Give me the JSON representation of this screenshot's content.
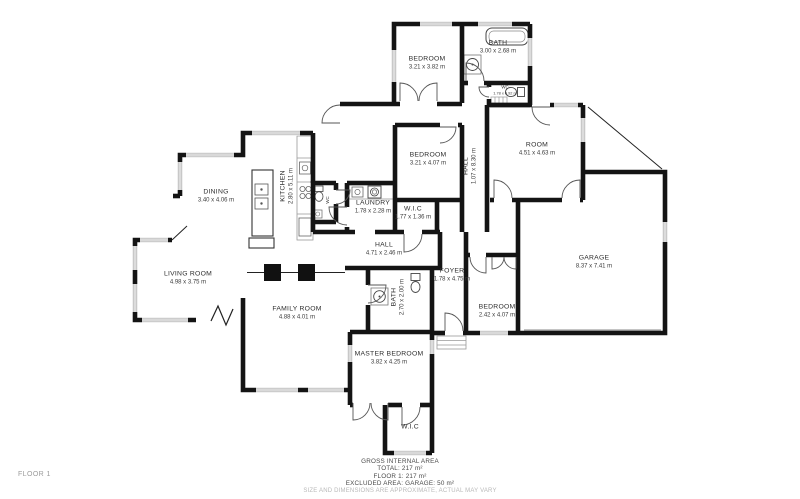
{
  "floorplan": {
    "floor_tag": "FLOOR 1",
    "rooms": [
      {
        "id": "bedroom-top",
        "name": "BEDROOM",
        "dims": "3.21 x 3.82 m"
      },
      {
        "id": "bath-top",
        "name": "BATH",
        "dims": "3.00 x 2.68 m"
      },
      {
        "id": "wc-top",
        "name": "WC",
        "dims": "1.78 x 0.92 m"
      },
      {
        "id": "bedroom-mid",
        "name": "BEDROOM",
        "dims": "3.21 x 4.07 m"
      },
      {
        "id": "hall-upper",
        "name": "HALL",
        "dims": "1.07 x 8.30 m"
      },
      {
        "id": "room",
        "name": "ROOM",
        "dims": "4.51 x 4.63 m"
      },
      {
        "id": "kitchen",
        "name": "KITCHEN",
        "dims": "2.80 x 5.11 m"
      },
      {
        "id": "dining",
        "name": "DINING",
        "dims": "3.40 x 4.06 m"
      },
      {
        "id": "wc-kitchen",
        "name": "WC",
        "dims": ""
      },
      {
        "id": "laundry",
        "name": "LAUNDRY",
        "dims": "1.78 x 2.28 m"
      },
      {
        "id": "wic-mid",
        "name": "W.I.C",
        "dims": "1.77 x 1.36 m"
      },
      {
        "id": "hall-main",
        "name": "HALL",
        "dims": "4.71 x 2.46 m"
      },
      {
        "id": "foyer",
        "name": "FOYER",
        "dims": "1.78 x 4.75 m"
      },
      {
        "id": "bath-mid",
        "name": "BATH",
        "dims": "2.70 x 2.00 m"
      },
      {
        "id": "bedroom-right",
        "name": "BEDROOM",
        "dims": "2.42 x 4.07 m"
      },
      {
        "id": "living-room",
        "name": "LIVING ROOM",
        "dims": "4.98 x 3.75 m"
      },
      {
        "id": "family-room",
        "name": "FAMILY ROOM",
        "dims": "4.88 x 4.01 m"
      },
      {
        "id": "master-bedroom",
        "name": "MASTER BEDROOM",
        "dims": "3.82 x 4.25 m"
      },
      {
        "id": "wic-bottom",
        "name": "W.I.C",
        "dims": ""
      },
      {
        "id": "garage",
        "name": "GARAGE",
        "dims": "8.37 x 7.41 m"
      }
    ],
    "footer": {
      "title": "GROSS INTERNAL AREA",
      "total": "TOTAL: 217 m²",
      "floor": "FLOOR 1: 217 m²",
      "excluded": "EXCLUDED AREA: GARAGE: 50 m²",
      "disclaimer": "SIZE AND DIMENSIONS ARE APPROXIMATE, ACTUAL MAY VARY"
    },
    "colors": {
      "wall": "#141414",
      "door": "#555555",
      "window": "#9a9a9a",
      "muted_text": "#b9b9b9"
    }
  }
}
